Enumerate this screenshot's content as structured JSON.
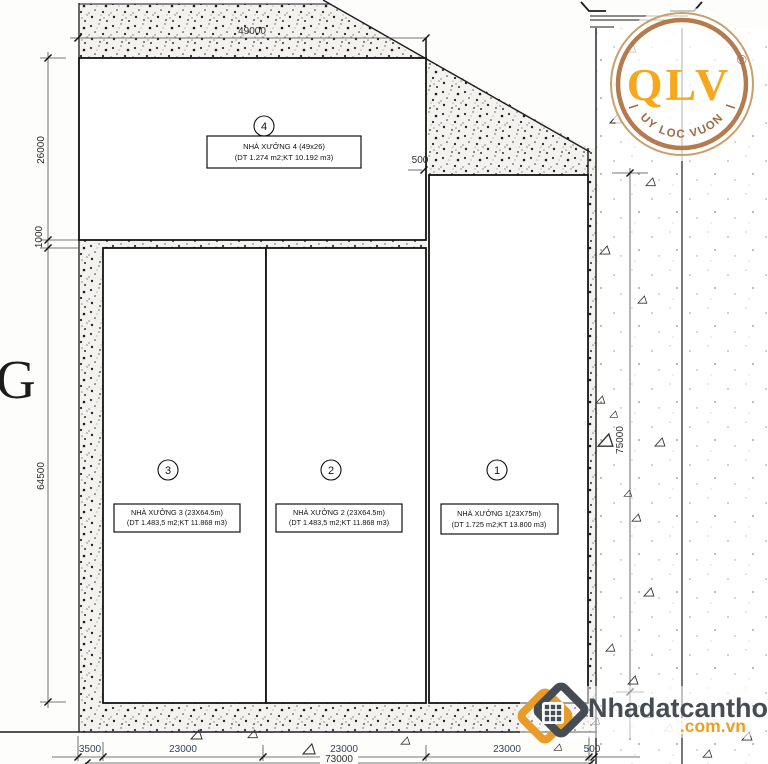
{
  "dimensions": {
    "top": "49000",
    "left": [
      "26000",
      "1000",
      "64500"
    ],
    "right": "75000",
    "gap": "500",
    "bottom": [
      "3500",
      "23000",
      "23000",
      "23000",
      "500"
    ],
    "total": "73000"
  },
  "grid_label": "G",
  "buildings": {
    "b1": {
      "number": "1",
      "title": "NHÀ XƯỞNG 1(23X75m)",
      "details": "(DT 1.725 m2;KT 13.800 m3)"
    },
    "b2": {
      "number": "2",
      "title": "NHÀ XƯỞNG 2 (23X64.5m)",
      "details": "(DT 1.483,5 m2;KT 11.868 m3)"
    },
    "b3": {
      "number": "3",
      "title": "NHÀ XƯỞNG 3 (23X64.5m)",
      "details": "(DT 1.483,5 m2;KT 11.868 m3)"
    },
    "b4": {
      "number": "4",
      "title": "NHÀ XƯỞNG 4 (49x26)",
      "details": "(DT 1.274 m2;KT 10.192 m3)"
    }
  },
  "qlv_logo": {
    "brand": "QLV",
    "registered": "®",
    "tagline": "QUY LOC VUONG"
  },
  "watermark": {
    "name": "Nhadatcantho",
    "domain": ".com.vn"
  },
  "colors": {
    "qlv_orange": "#f6a81c",
    "qlv_ring": "#b57a4e",
    "watermark_dark": "#454c54",
    "watermark_orange": "#f09d24"
  }
}
